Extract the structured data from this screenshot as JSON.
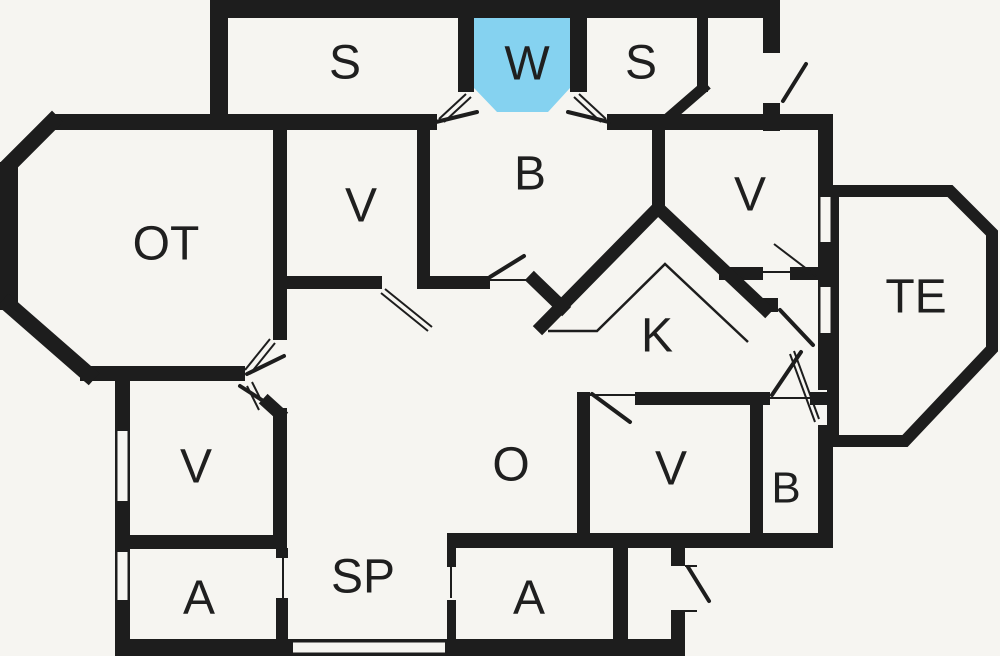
{
  "title": "Floor plan",
  "colors": {
    "background": "#f6f5f1",
    "wall": "#1d1d1d",
    "highlight_room": "#85d2f0",
    "label": "#1f1f1f"
  },
  "rooms": [
    {
      "id": "s-left",
      "label": "S",
      "x": 345,
      "y": 63,
      "size": 48
    },
    {
      "id": "w",
      "label": "W",
      "x": 527,
      "y": 64,
      "size": 48
    },
    {
      "id": "s-right",
      "label": "S",
      "x": 641,
      "y": 63,
      "size": 48
    },
    {
      "id": "b-top",
      "label": "B",
      "x": 530,
      "y": 174,
      "size": 48
    },
    {
      "id": "v-top",
      "label": "V",
      "x": 361,
      "y": 206,
      "size": 48
    },
    {
      "id": "v-topright",
      "label": "V",
      "x": 750,
      "y": 195,
      "size": 48
    },
    {
      "id": "ot",
      "label": "OT",
      "x": 166,
      "y": 244,
      "size": 48
    },
    {
      "id": "te",
      "label": "TE",
      "x": 916,
      "y": 297,
      "size": 48
    },
    {
      "id": "k",
      "label": "K",
      "x": 657,
      "y": 336,
      "size": 48
    },
    {
      "id": "v-left",
      "label": "V",
      "x": 196,
      "y": 467,
      "size": 48
    },
    {
      "id": "o",
      "label": "O",
      "x": 511,
      "y": 465,
      "size": 48
    },
    {
      "id": "v-bottom",
      "label": "V",
      "x": 671,
      "y": 469,
      "size": 48
    },
    {
      "id": "b-bottom",
      "label": "B",
      "x": 786,
      "y": 488,
      "size": 44
    },
    {
      "id": "a-left",
      "label": "A",
      "x": 199,
      "y": 598,
      "size": 48
    },
    {
      "id": "sp",
      "label": "SP",
      "x": 363,
      "y": 577,
      "size": 48
    },
    {
      "id": "a-right",
      "label": "A",
      "x": 529,
      "y": 598,
      "size": 48
    }
  ],
  "geometry": {
    "canvas": {
      "width": 1000,
      "height": 656
    },
    "highlight_polygon": [
      [
        474,
        14
      ],
      [
        570,
        14
      ],
      [
        570,
        88
      ],
      [
        548,
        112
      ],
      [
        497,
        112
      ],
      [
        474,
        88
      ]
    ],
    "te_polygon": [
      [
        833,
        191
      ],
      [
        950,
        191
      ],
      [
        992,
        233
      ],
      [
        992,
        349
      ],
      [
        905,
        441
      ],
      [
        833,
        441
      ]
    ],
    "te_stroke": 12,
    "wall_rects": [
      [
        210,
        0,
        570,
        18
      ],
      [
        210,
        0,
        18,
        118
      ],
      [
        763,
        0,
        17,
        53
      ],
      [
        763,
        103,
        17,
        28
      ],
      [
        458,
        14,
        16,
        78
      ],
      [
        570,
        14,
        17,
        78
      ],
      [
        697,
        14,
        11,
        78
      ],
      [
        50,
        114,
        387,
        16
      ],
      [
        607,
        114,
        226,
        16
      ],
      [
        0,
        162,
        18,
        148
      ],
      [
        80,
        366,
        165,
        15
      ],
      [
        273,
        130,
        14,
        210
      ],
      [
        287,
        276,
        95,
        13
      ],
      [
        417,
        130,
        13,
        155
      ],
      [
        417,
        276,
        73,
        13
      ],
      [
        652,
        118,
        13,
        97
      ],
      [
        719,
        267,
        44,
        13
      ],
      [
        790,
        267,
        28,
        13
      ],
      [
        818,
        114,
        15,
        83
      ],
      [
        818,
        242,
        15,
        45
      ],
      [
        818,
        333,
        15,
        57
      ],
      [
        818,
        425,
        15,
        123
      ],
      [
        577,
        392,
        13,
        143
      ],
      [
        635,
        392,
        135,
        13
      ],
      [
        810,
        392,
        23,
        13
      ],
      [
        750,
        398,
        13,
        137
      ],
      [
        447,
        533,
        386,
        15
      ],
      [
        613,
        548,
        15,
        108
      ],
      [
        671,
        548,
        14,
        18
      ],
      [
        671,
        610,
        14,
        46
      ],
      [
        115,
        374,
        15,
        57
      ],
      [
        115,
        501,
        15,
        51
      ],
      [
        115,
        600,
        15,
        56
      ],
      [
        273,
        408,
        14,
        127
      ],
      [
        115,
        535,
        172,
        14
      ],
      [
        276,
        548,
        12,
        10
      ],
      [
        276,
        598,
        12,
        58
      ],
      [
        115,
        639,
        178,
        17
      ],
      [
        445,
        639,
        240,
        17
      ],
      [
        447,
        548,
        9,
        19
      ],
      [
        447,
        600,
        9,
        56
      ],
      [
        762,
        298,
        16,
        14
      ]
    ],
    "wall_lines": [
      [
        52,
        122,
        4,
        170,
        16
      ],
      [
        9,
        305,
        88,
        374,
        16
      ],
      [
        703,
        88,
        666,
        120,
        11
      ],
      [
        534,
        280,
        562,
        307,
        13
      ],
      [
        268,
        403,
        279,
        413,
        13
      ]
    ],
    "chevron": {
      "points": [
        [
          542,
          326
        ],
        [
          658,
          208
        ],
        [
          765,
          309
        ]
      ],
      "width": 13
    },
    "thin_chevron": {
      "points": [
        [
          548,
          331
        ],
        [
          597,
          331
        ],
        [
          665,
          264
        ],
        [
          748,
          342
        ]
      ],
      "width": 2.5
    },
    "windows": [
      {
        "x": 818,
        "y": 197,
        "w": 15,
        "h": 45,
        "orient": "v"
      },
      {
        "x": 818,
        "y": 287,
        "w": 15,
        "h": 46,
        "orient": "v"
      },
      {
        "x": 115,
        "y": 431,
        "w": 15,
        "h": 70,
        "orient": "v"
      },
      {
        "x": 115,
        "y": 552,
        "w": 15,
        "h": 48,
        "orient": "v"
      },
      {
        "x": 293,
        "y": 639,
        "w": 152,
        "h": 17,
        "orient": "h"
      }
    ],
    "thin_lines": [
      [
        466,
        94,
        439,
        119
      ],
      [
        471,
        97,
        444,
        122
      ],
      [
        579,
        94,
        606,
        119
      ],
      [
        574,
        97,
        601,
        122
      ],
      [
        275,
        343,
        250,
        374
      ],
      [
        270,
        339,
        245,
        370
      ],
      [
        252,
        382,
        264,
        406
      ],
      [
        247,
        386,
        259,
        410
      ],
      [
        385,
        289,
        432,
        327
      ],
      [
        381,
        293,
        428,
        331
      ],
      [
        763,
        272,
        790,
        272
      ],
      [
        774,
        244,
        816,
        276
      ],
      [
        819,
        419,
        794,
        351
      ],
      [
        815,
        422,
        790,
        354
      ],
      [
        770,
        398,
        810,
        398
      ],
      [
        590,
        395,
        635,
        395
      ],
      [
        490,
        280,
        532,
        280
      ],
      [
        283,
        556,
        283,
        600
      ],
      [
        451,
        565,
        451,
        598
      ],
      [
        685,
        566,
        697,
        566
      ],
      [
        685,
        611,
        697,
        611
      ]
    ],
    "medium_lines": [
      [
        436,
        122,
        477,
        112
      ],
      [
        609,
        122,
        568,
        112
      ],
      [
        783,
        101,
        806,
        64
      ],
      [
        247,
        374,
        284,
        356
      ],
      [
        240,
        386,
        268,
        404
      ],
      [
        490,
        277,
        524,
        256
      ],
      [
        780,
        310,
        813,
        345
      ],
      [
        772,
        395,
        801,
        352
      ],
      [
        592,
        394,
        630,
        422
      ],
      [
        688,
        567,
        709,
        601
      ]
    ]
  }
}
